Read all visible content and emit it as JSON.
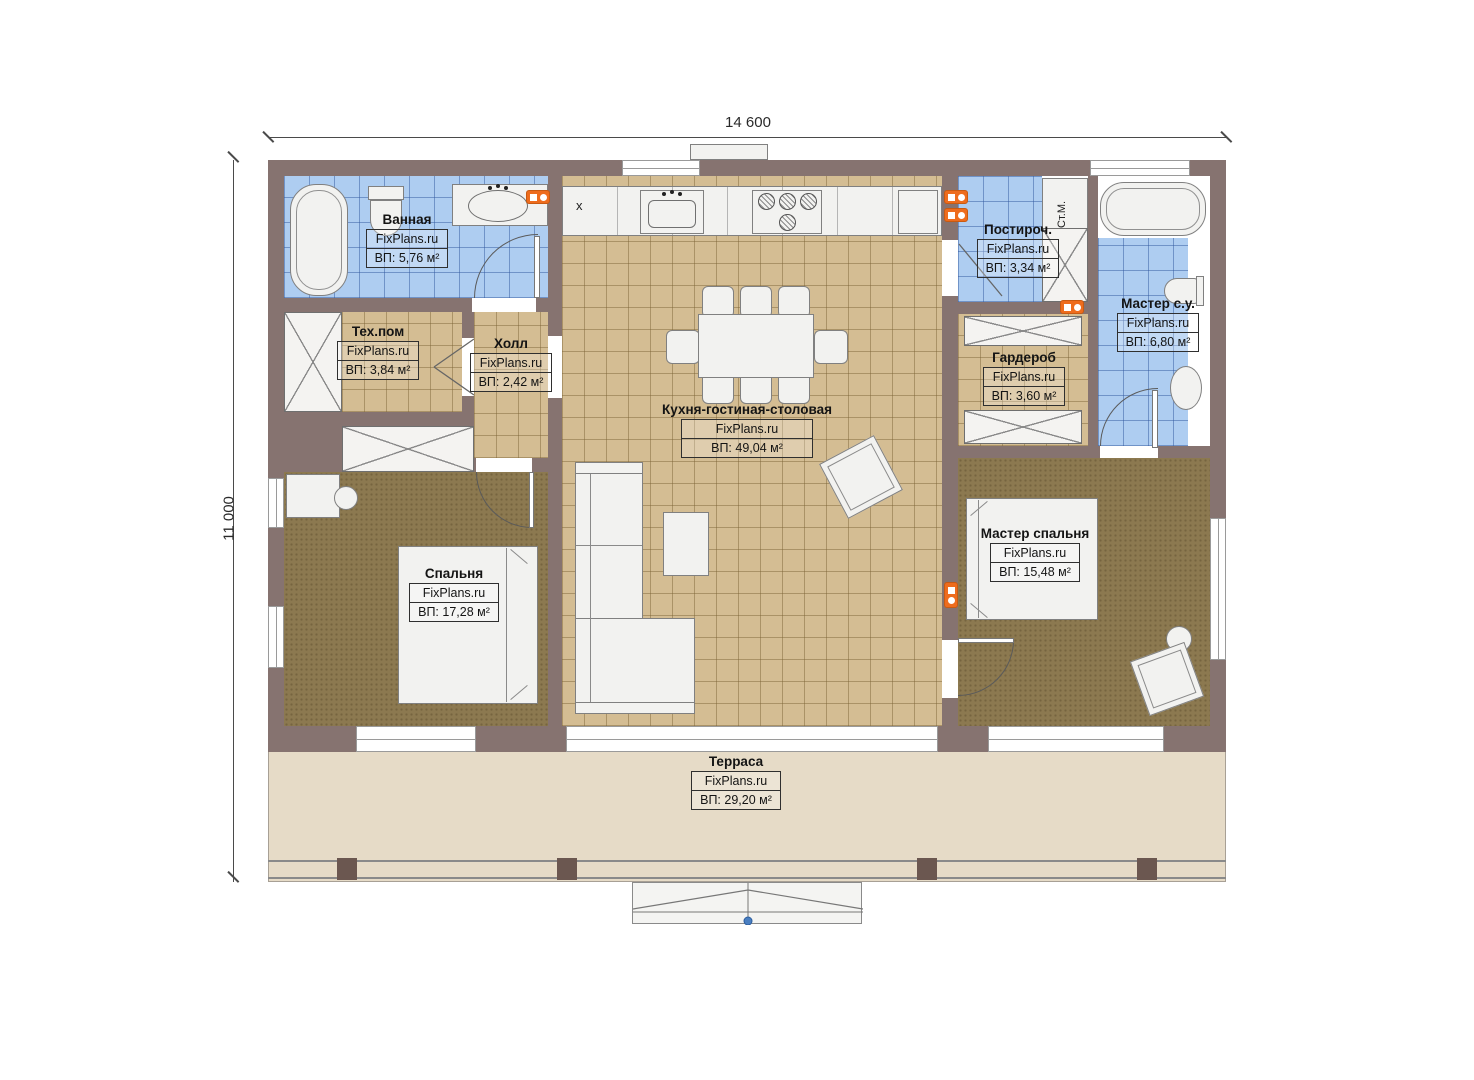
{
  "palette": {
    "wall": "#867370",
    "wall_dark": "#6e5b57",
    "tile_blue": "#aecdf1",
    "tile_blue_line": "#6f97cc",
    "tile_tan": "#d4bd93",
    "tile_tan_line": "#a8905e",
    "carpet": "#8c7950",
    "terrace": "#e6dbc7",
    "furniture": "#f2f2f0",
    "outline": "#808080",
    "accent_orange": "#ee6c1d",
    "accent_blue": "#4a7fc1",
    "text": "#1b1b1b"
  },
  "dimensions": {
    "width_label": "14 600",
    "height_label": "11 000"
  },
  "rooms": {
    "bathroom": {
      "name": "Ванная",
      "brand": "FixPlans.ru",
      "area": "ВП: 5,76 м²"
    },
    "tech": {
      "name": "Тех.пом",
      "brand": "FixPlans.ru",
      "area": "ВП: 3,84 м²"
    },
    "hall": {
      "name": "Холл",
      "brand": "FixPlans.ru",
      "area": "ВП: 2,42 м²"
    },
    "kitchen_living": {
      "name": "Кухня-гостиная-столовая",
      "brand": "FixPlans.ru",
      "area": "ВП: 49,04 м²"
    },
    "laundry": {
      "name": "Постироч.",
      "brand": "FixPlans.ru",
      "area": "ВП: 3,34 м²"
    },
    "master_bath": {
      "name": "Мастер с.у.",
      "brand": "FixPlans.ru",
      "area": "ВП: 6,80 м²"
    },
    "wardrobe": {
      "name": "Гардероб",
      "brand": "FixPlans.ru",
      "area": "ВП: 3,60 м²"
    },
    "bedroom": {
      "name": "Спальня",
      "brand": "FixPlans.ru",
      "area": "ВП: 17,28 м²"
    },
    "master_bedroom": {
      "name": "Мастер спальня",
      "brand": "FixPlans.ru",
      "area": "ВП: 15,48 м²"
    },
    "terrace": {
      "name": "Терраса",
      "brand": "FixPlans.ru",
      "area": "ВП: 29,20 м²"
    }
  },
  "annotations": {
    "washer": "Ст.М.",
    "kitchen_mark": "x"
  }
}
